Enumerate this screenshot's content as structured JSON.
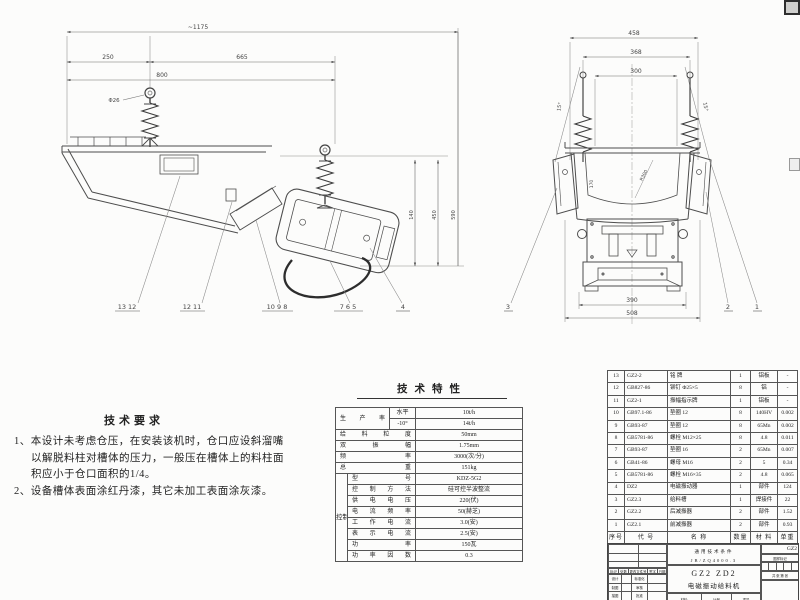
{
  "colors": {
    "line": "#555555",
    "text": "#222222",
    "paper": "#fcfcfb"
  },
  "tech_requirements": {
    "title": "技术要求",
    "line1": "1、本设计未考虑仓压，在安装该机时，仓口应设斜溜嘴",
    "line2": "以解脱料柱对槽体的压力，一般压在槽体上的料柱面",
    "line3": "积应小于仓口面积的1/4。",
    "line4": "2、设备槽体表面涂红丹漆，其它未加工表面涂灰漆。"
  },
  "spec_table": {
    "title": "技术特性",
    "prod_label": "生产率",
    "prod_rows": [
      {
        "cond": "水平",
        "value": "10t/h"
      },
      {
        "cond": "-10°",
        "value": "14t/h"
      }
    ],
    "simple_rows": [
      {
        "label": "给料粒度",
        "value": "50mm"
      },
      {
        "label": "双振幅",
        "value": "1.75mm"
      },
      {
        "label": "频率",
        "value": "3000(次/分)"
      },
      {
        "label": "总重",
        "value": "151kg"
      }
    ],
    "group_label": "控制箱",
    "control_rows": [
      {
        "label": "型号",
        "value": "KDZ-5G2"
      },
      {
        "label": "控制方法",
        "value": "硅可控半波整流"
      },
      {
        "label": "供电电压",
        "value": "220(伏)"
      },
      {
        "label": "电流频率",
        "value": "50(赫芝)"
      },
      {
        "label": "工作电流",
        "value": "3.0(安)"
      },
      {
        "label": "表示电流",
        "value": "2.5(安)"
      },
      {
        "label": "功率",
        "value": "150瓦"
      },
      {
        "label": "功率因数",
        "value": "0.3"
      }
    ]
  },
  "parts_list": {
    "columns": [
      "序号",
      "代 号",
      "名  称",
      "数量",
      "材 料",
      "单重"
    ],
    "rows": [
      {
        "no": "13",
        "code": "GZ2-2",
        "name": "铭  牌",
        "qty": "1",
        "mat": "铝板",
        "wt": "-"
      },
      {
        "no": "12",
        "code": "GB827-86",
        "name": "铆钉 Φ25×5",
        "qty": "8",
        "mat": "铝",
        "wt": "-"
      },
      {
        "no": "11",
        "code": "GZ2-1",
        "name": "振幅指示牌",
        "qty": "1",
        "mat": "铝板",
        "wt": "-"
      },
      {
        "no": "10",
        "code": "GB97.1-86",
        "name": "垫圈 12",
        "qty": "8",
        "mat": "140HV",
        "wt": "0.002"
      },
      {
        "no": "9",
        "code": "GB93-87",
        "name": "垫圈 12",
        "qty": "8",
        "mat": "65Mn",
        "wt": "0.002"
      },
      {
        "no": "8",
        "code": "GB5781-86",
        "name": "螺栓 M12×25",
        "qty": "8",
        "mat": "4.8",
        "wt": "0.011"
      },
      {
        "no": "7",
        "code": "GB93-87",
        "name": "垫圈 16",
        "qty": "2",
        "mat": "65Mn",
        "wt": "0.007"
      },
      {
        "no": "6",
        "code": "GB41-86",
        "name": "螺母 M16",
        "qty": "2",
        "mat": "5",
        "wt": "0.34"
      },
      {
        "no": "5",
        "code": "GB5781-86",
        "name": "螺栓 M16×35",
        "qty": "2",
        "mat": "4.8",
        "wt": "0.065"
      },
      {
        "no": "4",
        "code": "DZ2",
        "name": "电磁振动器",
        "qty": "1",
        "mat": "部件",
        "wt": "124"
      },
      {
        "no": "3",
        "code": "GZ2.3",
        "name": "给料槽",
        "qty": "1",
        "mat": "焊接件",
        "wt": "22"
      },
      {
        "no": "2",
        "code": "GZ2.2",
        "name": "后减振器",
        "qty": "2",
        "mat": "部件",
        "wt": "1.52"
      },
      {
        "no": "1",
        "code": "GZ2.1",
        "name": "前减振器",
        "qty": "2",
        "mat": "部件",
        "wt": "0.93"
      }
    ]
  },
  "title_block": {
    "std_line1": "通用技术条件",
    "std_line2": "JB/ZQ4000.3",
    "model": "GZ2 ZD2",
    "product_name": "电磁振动给料机",
    "material_label": "材料:",
    "scale_label": "比例",
    "weight_label": "重量",
    "drawing_no": "GZ2",
    "mark_label": "图样标记",
    "sheet_label": "共 张 第 张",
    "change_cells": [
      "标记",
      "处数",
      "更改文件号",
      "签字",
      "日期"
    ],
    "sign_left": [
      "设计",
      "制图",
      "描图",
      "校核"
    ],
    "sign_right": [
      "标准化",
      "审核",
      "批准",
      "日期"
    ]
  },
  "side_view": {
    "dims": {
      "total": "~1175",
      "left": "250",
      "mid": "665",
      "span": "800",
      "hook": "Φ26",
      "v1": "140",
      "v2": "450",
      "v3": "590"
    },
    "callouts": [
      "13 12",
      "12 11",
      "10 9 8",
      "7 6 5",
      "4"
    ]
  },
  "front_view": {
    "dims": {
      "top": "458",
      "mid": "368",
      "inner": "300",
      "angle_left": "15°",
      "angle_right": "15°",
      "depth": "170",
      "radius": "R300",
      "bottom_inner": "390",
      "bottom": "508"
    },
    "callouts": [
      "3",
      "2",
      "1"
    ]
  }
}
